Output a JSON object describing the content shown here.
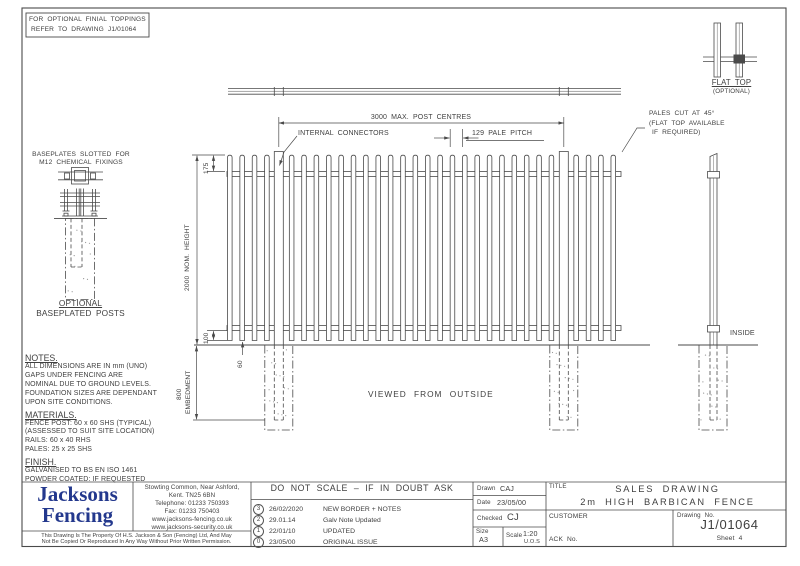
{
  "finial_note": {
    "line1": "FOR OPTIONAL FINIAL TOPPINGS",
    "line2": "REFER TO DRAWING J1/01064"
  },
  "baseplate_detail": {
    "note_line1": "BASEPLATES SLOTTED FOR",
    "note_line2": "M12 CHEMICAL FIXINGS",
    "caption_line1": "OPTIONAL",
    "caption_line2": "BASEPLATED POSTS"
  },
  "flat_top_detail": {
    "label": "FLAT TOP",
    "sublabel": "(OPTIONAL)"
  },
  "pales_cut_note": {
    "line1": "PALES CUT AT 45°",
    "line2": "(FLAT TOP AVAILABLE",
    "line3": "IF REQUIRED)"
  },
  "dimensions": {
    "post_centres": "3000 MAX. POST CENTRES",
    "internal_connectors": "INTERNAL CONNECTORS",
    "pale_pitch": "129 PALE PITCH",
    "nom_height": "2000 NOM. HEIGHT",
    "top_offset": "175",
    "rail_offset": "100",
    "ground_gap": "60",
    "embedment": "800",
    "embedment_label": "EMBEDMENT"
  },
  "labels": {
    "viewed_from": "VIEWED FROM OUTSIDE",
    "inside": "INSIDE"
  },
  "notes": {
    "heading": "NOTES.",
    "lines": [
      "ALL DIMENSIONS ARE IN mm (UNO)",
      "GAPS UNDER FENCING ARE",
      "NOMINAL DUE TO GROUND LEVELS.",
      "FOUNDATION SIZES ARE DEPENDANT",
      "UPON SITE CONDITIONS."
    ],
    "materials_heading": "MATERIALS.",
    "materials_lines": [
      "FENCE POST: 60 x 60 SHS (TYPICAL)",
      "(ASSESSED TO SUIT SITE LOCATION)",
      "RAILS: 60 x 40 RHS",
      "PALES: 25 x 25 SHS"
    ],
    "finish_heading": "FINISH.",
    "finish_lines": [
      "GALVANISED TO BS EN ISO 1461",
      "POWDER COATED: IF REQUESTED"
    ]
  },
  "title_block": {
    "company_line1": "Jacksons",
    "company_line2": "Fencing",
    "address_lines": [
      "Stowting Common, Near Ashford,",
      "Kent. TN25 6BN",
      "Telephone: 01233 750393",
      "Fax: 01233 750403",
      "www.jacksons-fencing.co.uk",
      "www.jacksons-security.co.uk"
    ],
    "property_line1": "This Drawing Is The Property Of H.S. Jackson & Son (Fencing) Ltd, And May",
    "property_line2": "Not Be Copied Or Reproduced In Any Way Without Prior Written Permission.",
    "do_not_scale": "DO NOT SCALE – IF IN DOUBT ASK",
    "revisions": [
      {
        "rev": "3",
        "date": "26/02/2020",
        "desc": "NEW BORDER + NOTES"
      },
      {
        "rev": "2",
        "date": "29.01.14",
        "desc": "Galv Note Updated"
      },
      {
        "rev": "1",
        "date": "22/01/10",
        "desc": "UPDATED"
      },
      {
        "rev": "0",
        "date": "23/05/00",
        "desc": "ORIGINAL ISSUE"
      }
    ],
    "drawn_label": "Drawn",
    "drawn": "CAJ",
    "date_label": "Date",
    "date": "23/05/00",
    "checked_label": "Checked",
    "checked": "CJ",
    "size_label": "Size",
    "size": "A3",
    "scale_label": "Scale",
    "scale": "1:20",
    "scale_suffix": "U.O.S",
    "title_label": "TITLE",
    "title_line1": "SALES DRAWING",
    "title_line2": "2m HIGH BARBICAN FENCE",
    "customer_label": "CUSTOMER",
    "ack_label": "ACK  No.",
    "drawing_no_label": "Drawing  No.",
    "drawing_no": "J1/01064",
    "sheet": "Sheet 4"
  },
  "colors": {
    "line": "#4a4a4a",
    "text": "#3f3f3f",
    "logo_blue": "#23388d"
  }
}
